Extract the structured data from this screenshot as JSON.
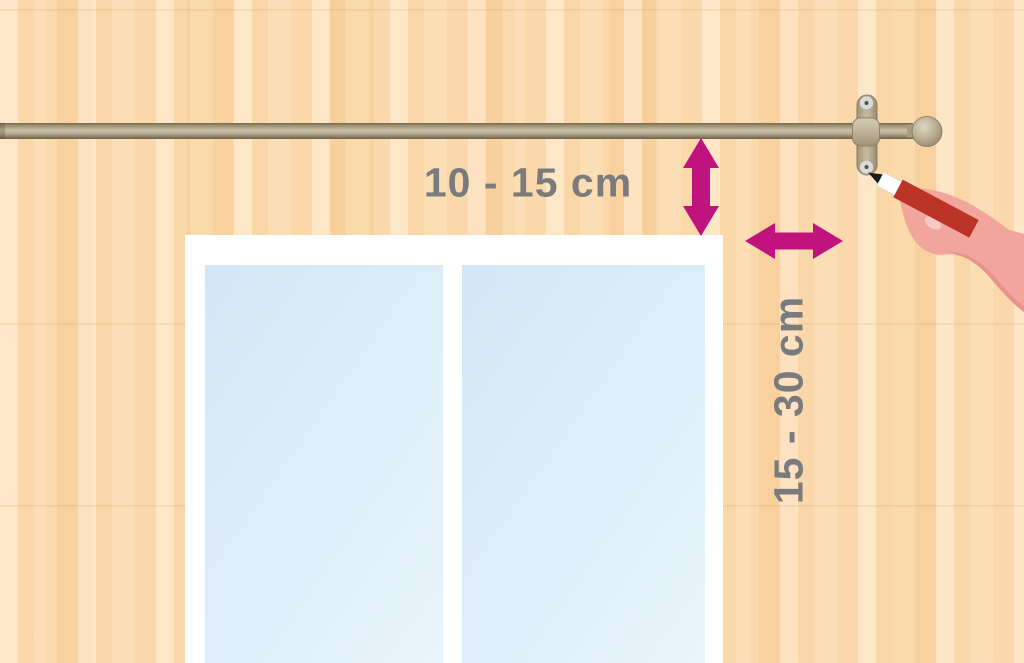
{
  "diagram": {
    "description": "Instructional illustration: marking curtain-rod bracket position above and beside a window with a pencil",
    "measurements": {
      "rod_above_window": "10 - 15 cm",
      "bracket_beside_window": "15 - 30 cm"
    },
    "colors": {
      "accent_magenta": "#C1137E",
      "label_gray": "#7B7B7B",
      "wall_peach": "#FAD7A9",
      "window_frame_white": "#FFFFFF",
      "glass_blue": "#D9EBF7",
      "rod_tan": "#BFB299",
      "pencil_red": "#BC3327",
      "pencil_ferrule_white": "#FFFFFF",
      "pencil_tip_black": "#1C1C1C",
      "hand_pink": "#F1A59D",
      "hand_shade_pink": "#E7928B",
      "nail_pink": "#F6C8C0"
    },
    "icons": {
      "vertical_arrow": "double-headed-vertical-arrow",
      "horizontal_arrow": "double-headed-horizontal-arrow"
    }
  }
}
